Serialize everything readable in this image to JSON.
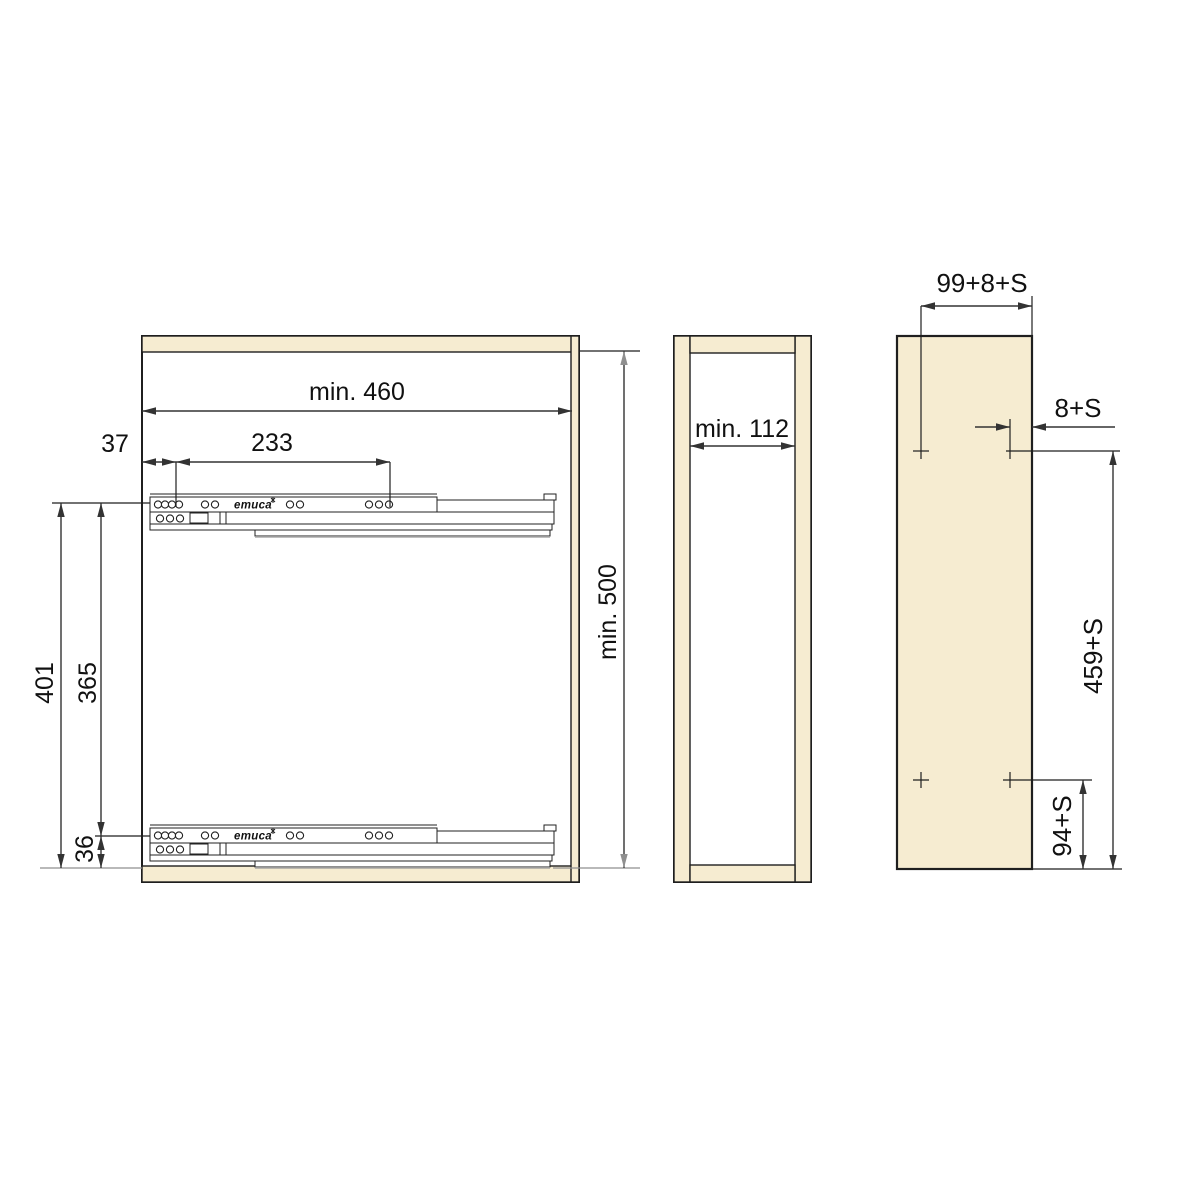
{
  "colors": {
    "background": "#ffffff",
    "wood_fill": "#f6ecd1",
    "outline": "#1f1f1f",
    "dimension": "#333333",
    "gray_line": "#8f8f8f"
  },
  "front_view": {
    "runner_brand": "emuca",
    "width_dim": "min. 460",
    "height_dim": "min. 500",
    "front_setback_dim": "37",
    "screw_pitch_dim": "233",
    "upper_runner_dim": "401",
    "runner_gap_dim": "365",
    "lower_runner_dim": "36"
  },
  "side_view": {
    "inner_width_dim": "min. 112"
  },
  "back_panel_view": {
    "top_width_dim": "99+8+S",
    "side_offset_dim": "8+S",
    "upper_holes_dim": "459+S",
    "lower_holes_dim": "94+S"
  }
}
